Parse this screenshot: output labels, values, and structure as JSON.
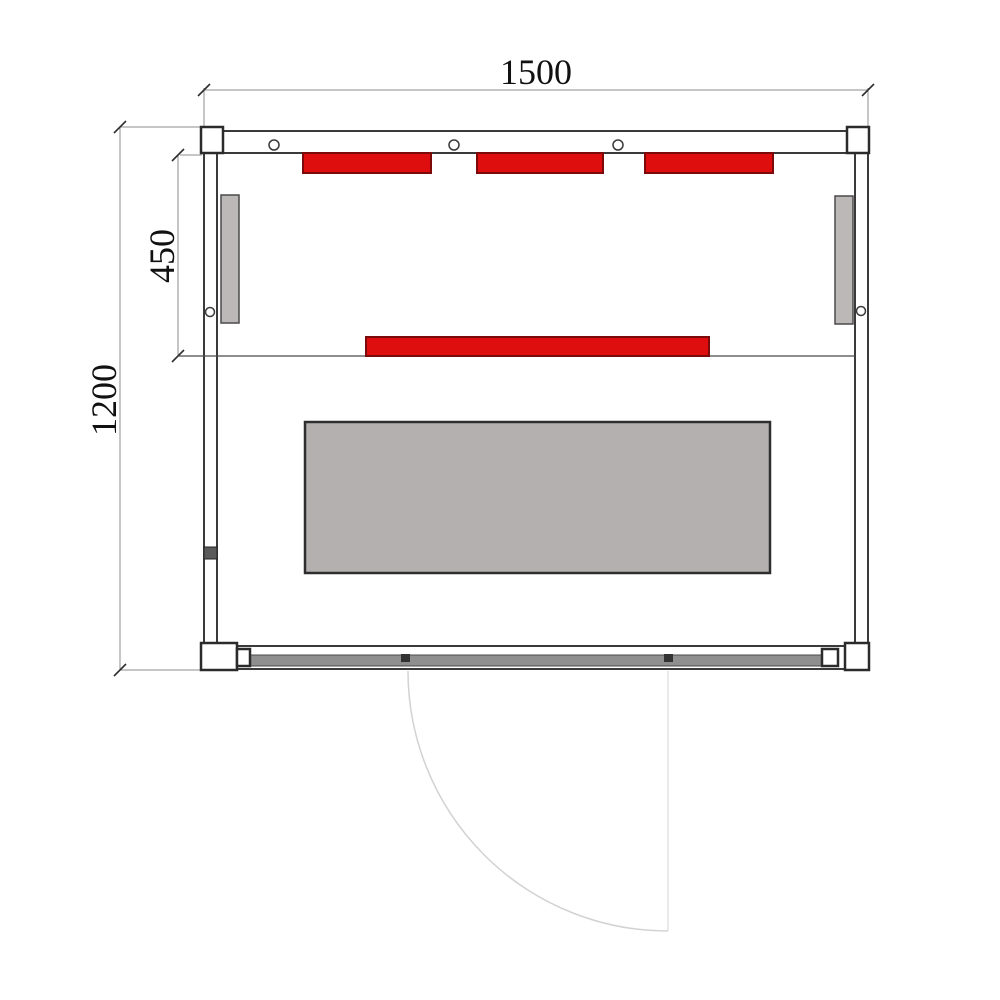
{
  "drawing": {
    "type": "sauna-floor-plan-top-view",
    "labels": {
      "overall_width": "1500",
      "overall_depth": "1200",
      "heater_zone_depth": "450"
    },
    "counts": {
      "top_red_heaters": 3,
      "middle_red_heaters": 1,
      "side_wall_panels": 2,
      "top_wall_screws": 3
    }
  },
  "colors": {
    "heater_red": "#de0e0e",
    "heater_red_border": "#7d0a0a",
    "bench_gray": "#b4b0b0",
    "bench_border": "#2e2e2e",
    "side_panel_gray": "#bdb8b8",
    "glass_band_gray": "#8f8f8f",
    "wall_line": "#3a3a3a",
    "dim_line": "#8c8c8c",
    "label_text": "#111111",
    "door_arc": "#d2d2d2"
  }
}
